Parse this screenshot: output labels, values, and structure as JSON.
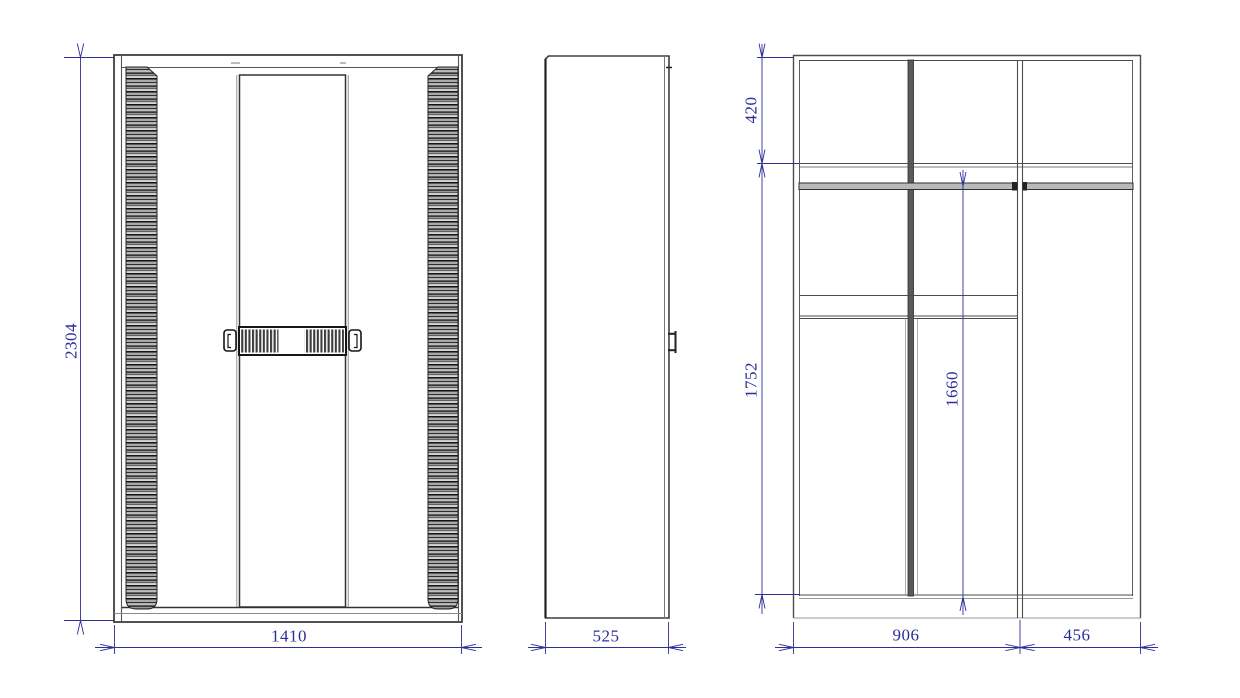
{
  "drawing": {
    "dimensions": {
      "overall_height": "2304",
      "overall_width": "1410",
      "depth": "525",
      "top_section_height": "420",
      "interior_height": "1752",
      "hanging_height": "1660",
      "left_section_width": "906",
      "right_section_width": "456"
    },
    "colors": {
      "structure_line": "#4d4d4d",
      "dark_line": "#1f1f1f",
      "dimension": "#2d2d9b",
      "background": "#ffffff"
    }
  }
}
